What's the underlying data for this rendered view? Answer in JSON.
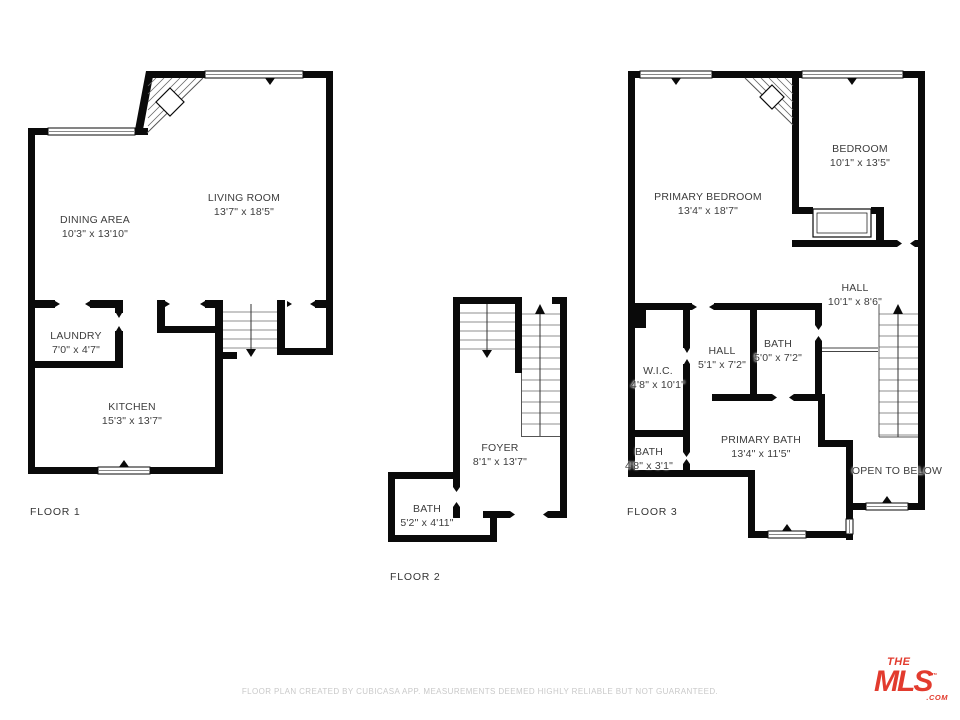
{
  "document": {
    "footer": "FLOOR PLAN CREATED BY CUBICASA APP. MEASUREMENTS DEEMED HIGHLY RELIABLE BUT NOT GUARANTEED.",
    "logo": {
      "the": "THE",
      "mls": "MLS",
      "tm": "™",
      "com": ".COM",
      "color": "#e23b2e"
    }
  },
  "floors": [
    {
      "label": "FLOOR 1",
      "label_pos": {
        "x": 30,
        "y": 506
      },
      "rooms": [
        {
          "name": "LIVING ROOM",
          "dims": "13'7\" x 18'5\"",
          "x": 244,
          "y": 205
        },
        {
          "name": "DINING AREA",
          "dims": "10'3\" x 13'10\"",
          "x": 95,
          "y": 227
        },
        {
          "name": "LAUNDRY",
          "dims": "7'0\" x 4'7\"",
          "x": 76,
          "y": 343
        },
        {
          "name": "KITCHEN",
          "dims": "15'3\" x 13'7\"",
          "x": 132,
          "y": 414
        }
      ]
    },
    {
      "label": "FLOOR 2",
      "label_pos": {
        "x": 390,
        "y": 571
      },
      "rooms": [
        {
          "name": "FOYER",
          "dims": "8'1\" x 13'7\"",
          "x": 500,
          "y": 455
        },
        {
          "name": "BATH",
          "dims": "5'2\" x 4'11\"",
          "x": 427,
          "y": 516
        }
      ]
    },
    {
      "label": "FLOOR 3",
      "label_pos": {
        "x": 627,
        "y": 506
      },
      "rooms": [
        {
          "name": "PRIMARY BEDROOM",
          "dims": "13'4\" x 18'7\"",
          "x": 708,
          "y": 204
        },
        {
          "name": "BEDROOM",
          "dims": "10'1\" x 13'5\"",
          "x": 860,
          "y": 156
        },
        {
          "name": "HALL",
          "dims": "10'1\" x 8'6\"",
          "x": 855,
          "y": 295
        },
        {
          "name": "W.I.C.",
          "dims": "4'8\" x 10'1\"",
          "x": 658,
          "y": 378
        },
        {
          "name": "HALL",
          "dims": "5'1\" x 7'2\"",
          "x": 722,
          "y": 358
        },
        {
          "name": "BATH",
          "dims": "5'0\" x 7'2\"",
          "x": 778,
          "y": 351
        },
        {
          "name": "PRIMARY BATH",
          "dims": "13'4\" x 11'5\"",
          "x": 761,
          "y": 447
        },
        {
          "name": "BATH",
          "dims": "4'8\" x 3'1\"",
          "x": 649,
          "y": 459
        },
        {
          "name": "OPEN TO BELOW",
          "dims": "",
          "x": 897,
          "y": 471
        }
      ]
    }
  ]
}
